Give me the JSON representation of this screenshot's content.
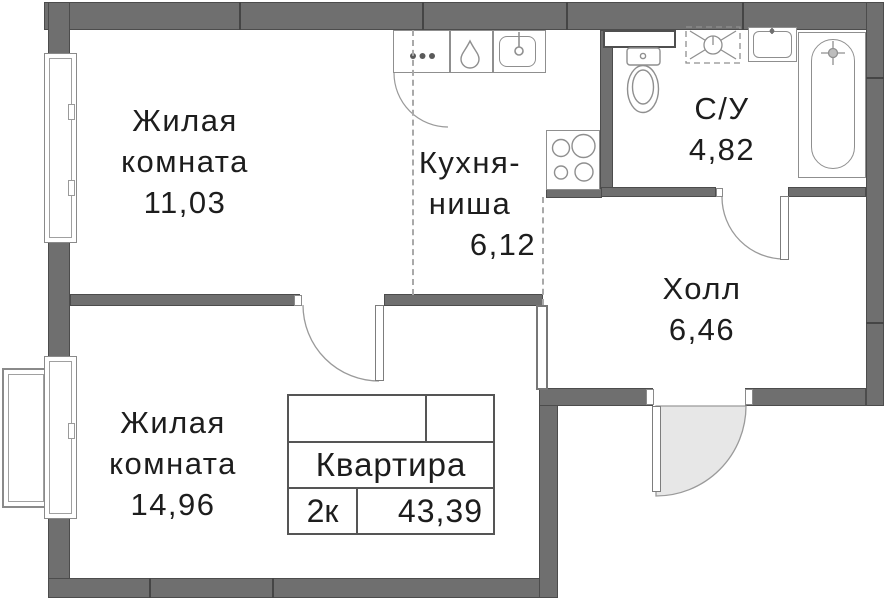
{
  "plan": {
    "title": "Floor plan of a 2-room apartment",
    "rooms": [
      {
        "id": "living-1",
        "lines": [
          "Жилая",
          "комната"
        ],
        "area": "11,03"
      },
      {
        "id": "kitchen-niche",
        "lines": [
          "Кухня-",
          "ниша"
        ],
        "area": "6,12"
      },
      {
        "id": "bathroom",
        "lines": [
          "С/У"
        ],
        "area": "4,82"
      },
      {
        "id": "hall",
        "lines": [
          "Холл"
        ],
        "area": "6,46"
      },
      {
        "id": "living-2",
        "lines": [
          "Жилая",
          "комната"
        ],
        "area": "14,96"
      }
    ],
    "stamp": {
      "title": "Квартира",
      "type": "2к",
      "area": "43,39"
    },
    "colors": {
      "wall": "#6f6f6f",
      "wall_border": "#4c4c4c",
      "fixture_line": "#8f8f8f",
      "door_shade": "#e7e7e7",
      "text": "#1d1d1d",
      "background": "#ffffff"
    }
  }
}
